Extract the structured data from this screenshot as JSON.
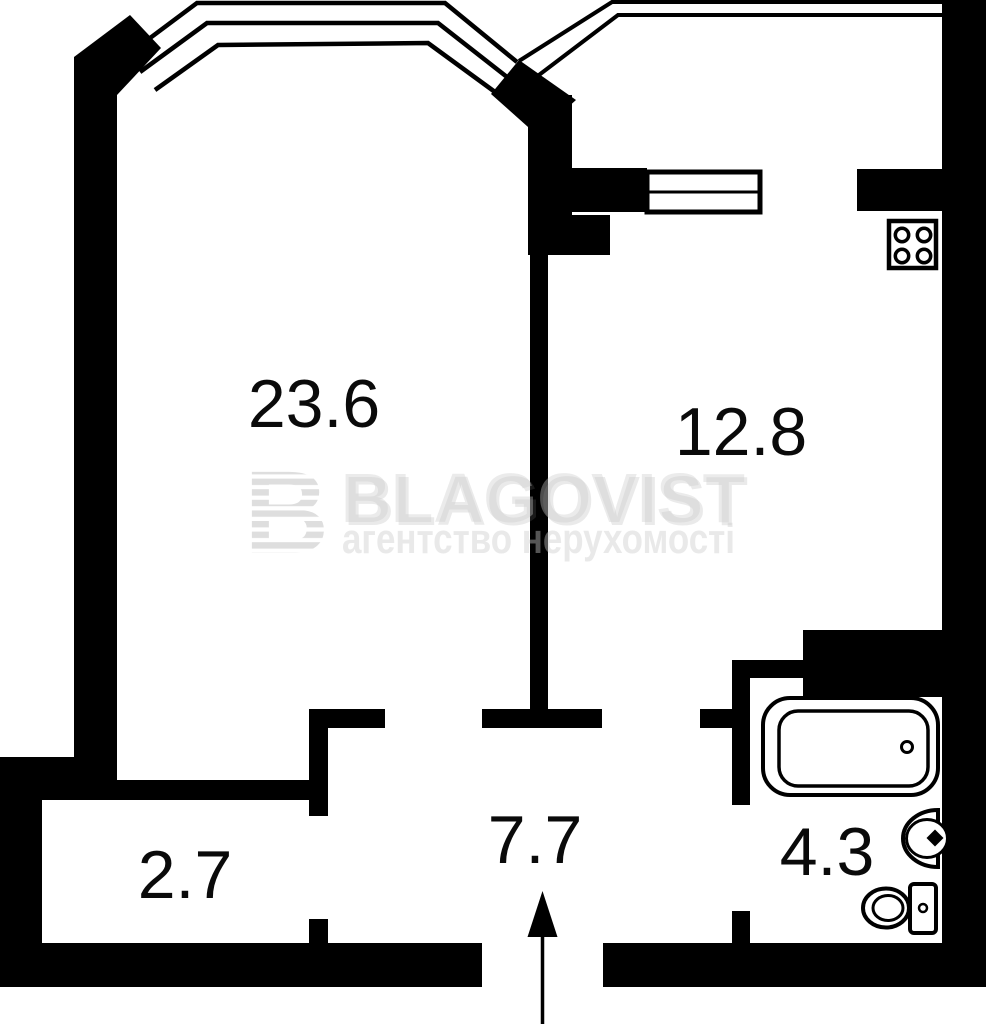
{
  "plan": {
    "type": "apartment-floor-plan",
    "colors": {
      "wall": "#000000",
      "background": "#ffffff",
      "watermark": "#cbcbcb"
    },
    "rooms": [
      {
        "id": "living-room",
        "area": "23.6"
      },
      {
        "id": "kitchen",
        "area": "12.8"
      },
      {
        "id": "hallway",
        "area": "7.7"
      },
      {
        "id": "storage",
        "area": "2.7"
      },
      {
        "id": "bathroom",
        "area": "4.3"
      }
    ],
    "fixtures": [
      "stove",
      "bathtub",
      "sink",
      "toilet"
    ],
    "entrance_arrow_direction": "up"
  },
  "watermark": {
    "logo_letter": "B",
    "brand": "BLAGOVIST",
    "tagline": "агентство нерухомості"
  }
}
